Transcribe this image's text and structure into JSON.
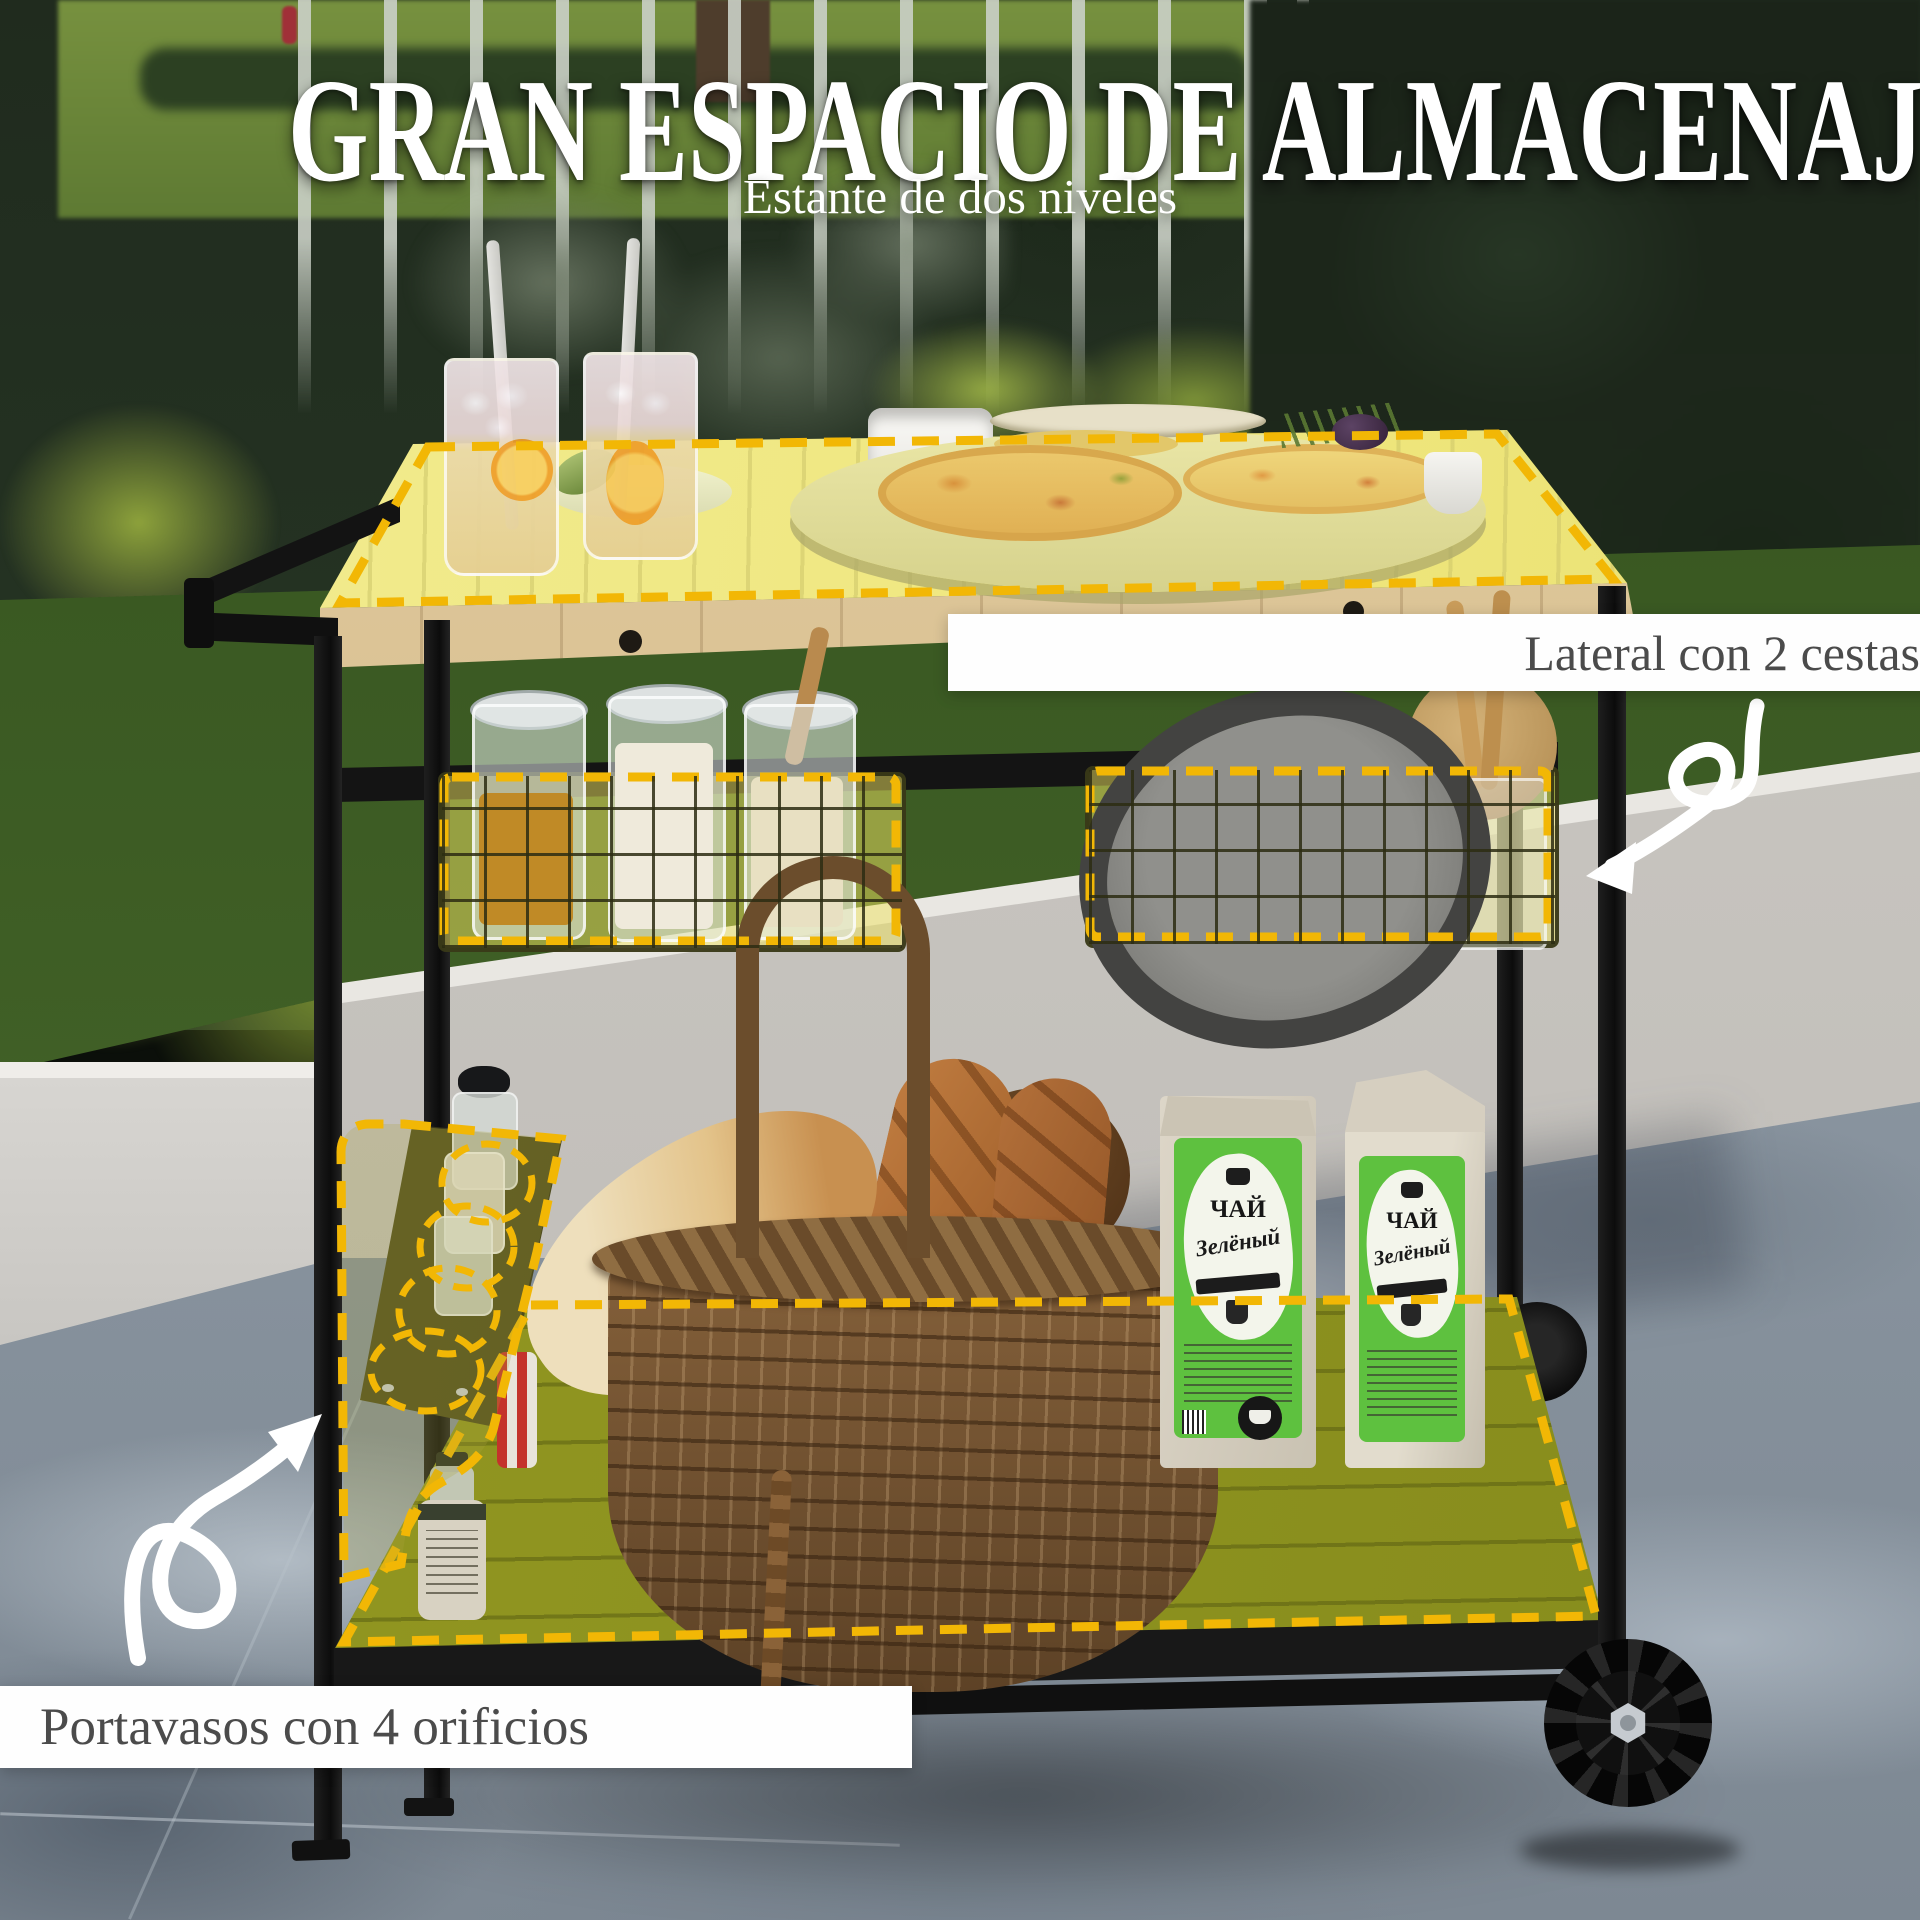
{
  "header": {
    "title": "GRAN ESPACIO DE ALMACENAJE",
    "subtitle": "Estante de dos niveles"
  },
  "callouts": {
    "baskets": {
      "label": "Lateral con 2 cestas"
    },
    "cup_holder": {
      "label": "Portavasos con 4 orificios"
    }
  },
  "tea_bag": {
    "line1": "ЧАЙ",
    "line2": "Зелёный"
  },
  "icons": {
    "arrow_to_baskets": "curved-arrow",
    "arrow_to_cup_holder": "curved-arrow"
  },
  "colors": {
    "dash": "#F2B705",
    "highlight_fill": "#F5E96B",
    "shelf_highlight": "#8E931F",
    "label_text": "#4B4B4B",
    "title_text": "#FFFFFF"
  }
}
